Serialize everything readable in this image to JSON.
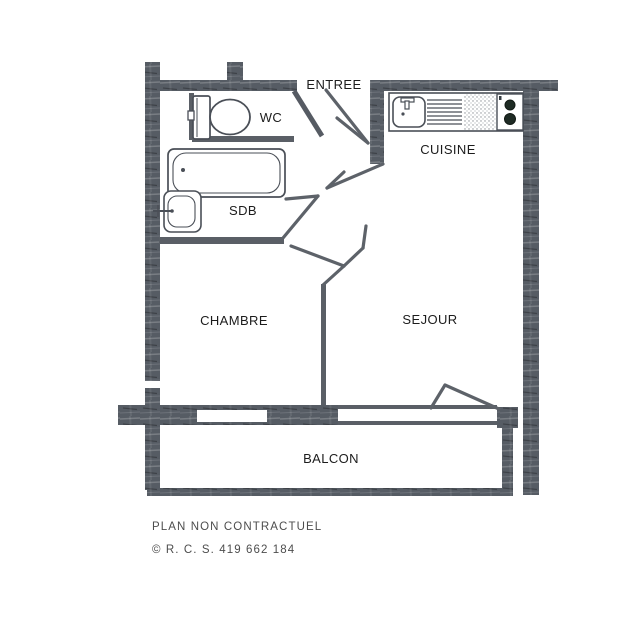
{
  "rooms": {
    "entree": {
      "label": "ENTREE"
    },
    "wc": {
      "label": "WC"
    },
    "cuisine": {
      "label": "CUISINE"
    },
    "sdb": {
      "label": "SDB"
    },
    "chambre": {
      "label": "CHAMBRE"
    },
    "sejour": {
      "label": "SEJOUR"
    },
    "balcon": {
      "label": "BALCON"
    }
  },
  "footer": {
    "disclaimer": "PLAN NON CONTRACTUEL",
    "registration": "© R. C. S. 419 662 184"
  },
  "colors": {
    "wall": "#565c64",
    "thin_wall": "#5a5f66",
    "door_line": "#5d6269",
    "fixture_outline": "#4a4f57",
    "label_text": "#1c1c1c",
    "footer_text": "#4d4d4d",
    "burner": "#1e2b24",
    "background": "#ffffff"
  }
}
